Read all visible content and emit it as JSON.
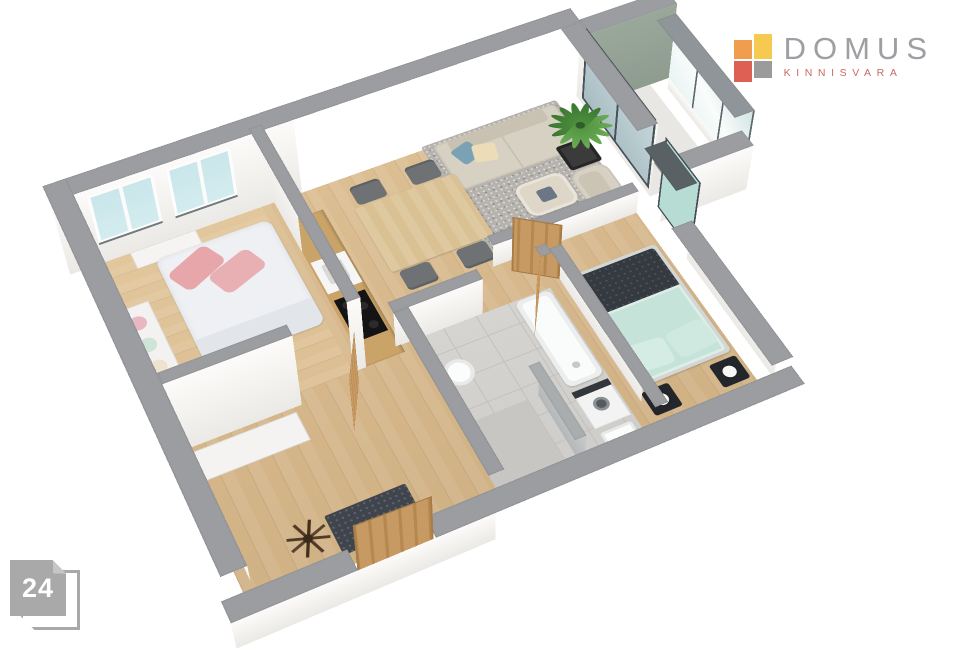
{
  "page": {
    "background": "#ffffff",
    "badge_number": "24"
  },
  "logo": {
    "title": "DOMUS",
    "subtitle": "KINNISVARA",
    "mark": {
      "top_left": "#f09d4e",
      "top_right": "#f6c94f",
      "bottom_left": "#de6054",
      "bottom_right": "#9b9b9b"
    }
  },
  "palette": {
    "wall-cap": "#9b9da0",
    "wall-face-1": "#ebe9e5",
    "wall-face-2": "#fcfbf9",
    "wood": "#dcbe93",
    "wood-dark": "#d0b184",
    "wood-light": "#e2c79c",
    "tile": "#d6d4d0",
    "tile-line": "#c2c0bc",
    "rug": "#b6b2ae",
    "sofa": "#d7d1c3",
    "sofa-dark": "#c9c2b2",
    "glass": "#d4ecef",
    "glass-frame": "#717a7d",
    "balcony-wall": "#9aa89b",
    "teal-glass": "#b7dcd4",
    "door-wood": "#c79a63",
    "duvet": "#eef0f3",
    "pink": "#e7a6aa",
    "mint": "#c6e3da",
    "dark-bed": "#343a40",
    "mat": "#40454d",
    "logo-gray": "#9d9fa2",
    "logo-red": "#c96a63",
    "badge-gray": "#a9a9a9"
  }
}
